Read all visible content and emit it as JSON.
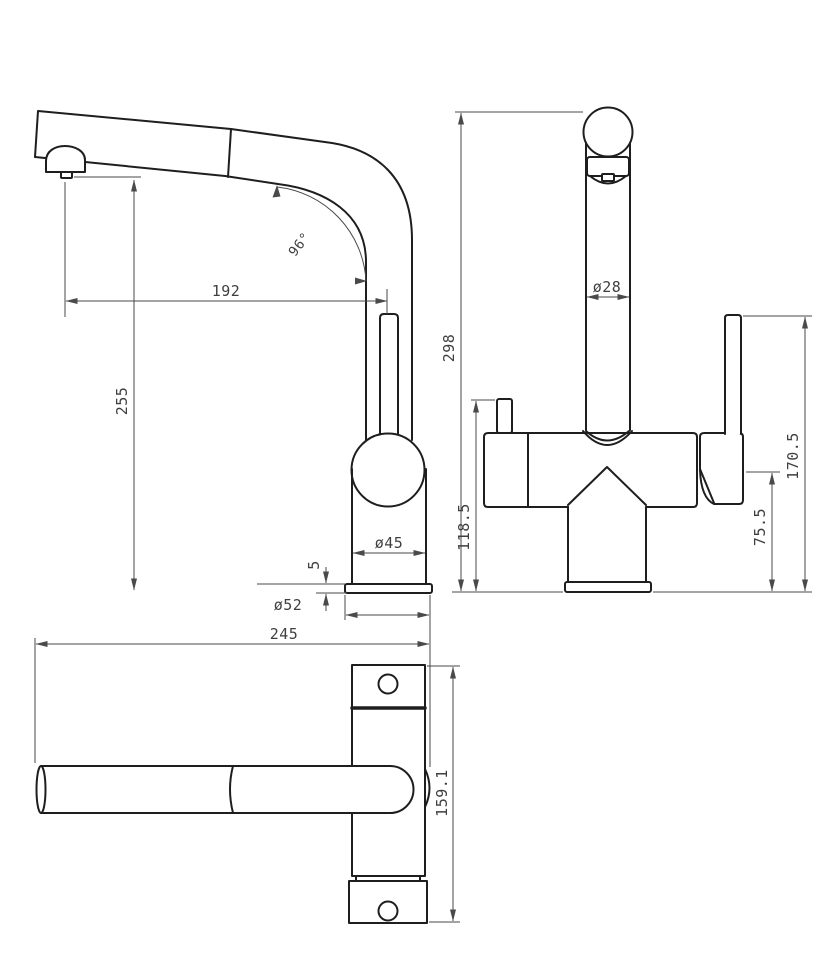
{
  "meta": {
    "title": "Kitchen faucet technical drawing - three orthographic views",
    "drawing_type": "technical-drawing",
    "background_color": "#ffffff",
    "outline_color": "#1e1e1e",
    "dimension_color": "#4a4a4a",
    "text_color": "#3f3f3f"
  },
  "views": {
    "side_view_label": "side view (spout profile)",
    "front_view_label": "front view (column and handle)",
    "top_view_label": "top view (plan)"
  },
  "dimensions": {
    "side_view": {
      "spout_reach": "192",
      "spout_tip_height": "255",
      "spout_angle": "96°",
      "body_diameter": "ø45",
      "base_plate_thickness": "5",
      "base_diameter": "ø52"
    },
    "front_view": {
      "overall_height": "298",
      "column_diameter": "ø28",
      "body_top_height": "118.5",
      "handle_hub_height": "75.5",
      "handle_top_height": "170.5"
    },
    "top_view": {
      "overall_reach": "245",
      "overall_depth": "159.1"
    }
  }
}
